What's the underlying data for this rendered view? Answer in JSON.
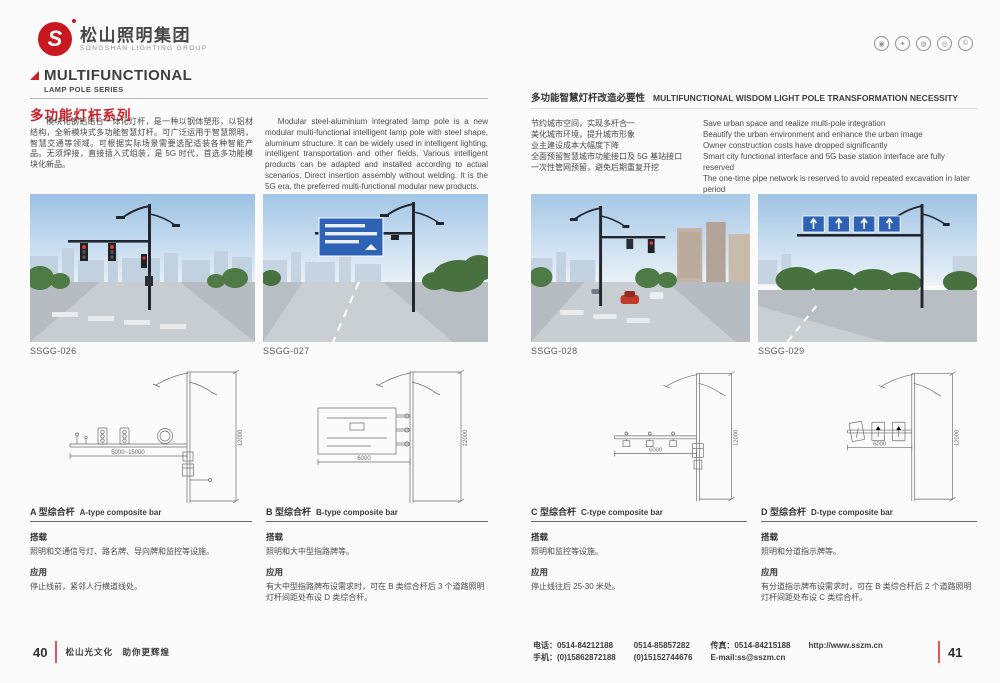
{
  "header": {
    "logo_mark": "S",
    "logo_cn": "松山照明集团",
    "logo_en": "SONGSHAN LIGHTING GROUP"
  },
  "left_page": {
    "series_title_en": "MULTIFUNCTIONAL",
    "series_subtitle_en": "LAMP POLE SERIES",
    "series_title_cn": "多功能灯杆系列",
    "intro_cn": "模块化钢铝结合一体化灯杆，是一种以钢体塑形，以铝材结构，全新模块式多功能智慧灯杆。可广泛运用于智慧照明，智慧交通等领域。可根据实际场景需要选配适装各种智能产品。无须焊接，直接插入式组装，是 5G 时代，首选多功能模块化新品。",
    "intro_en": "Modular steel-aluminium integrated lamp pole is a new modular multi-functional intelligent lamp pole with steel shape, aluminum structure. It can be widely used in intelligent lighting, intelligent transportation and other fields. Various intelligent products can be adapted and installed according to actual scenarios. Direct insertion assembly without welding. It is the 5G era, the preferred multi-functional modular new products.",
    "photo_codes": [
      "SSGG-026",
      "SSGG-027"
    ],
    "sections": [
      {
        "title_cn": "A 型综合杆",
        "title_en": "A-type composite bar",
        "load_label": "搭载",
        "load_text": "照明和交通信号灯、路名牌、导向牌和监控等设施。",
        "app_label": "应用",
        "app_text": "停止线前，紧邻人行横道线处。"
      },
      {
        "title_cn": "B 型综合杆",
        "title_en": "B-type composite bar",
        "load_label": "搭载",
        "load_text": "照明和大中型指路牌等。",
        "app_label": "应用",
        "app_text": "有大中型指路牌布设需求时，可在 B 类综合杆后 3 个道路照明灯杆间距处布设 D 类综合杆。"
      }
    ]
  },
  "right_page": {
    "necessity_title_cn": "多功能智慧灯杆改造必要性",
    "necessity_title_en": "MULTIFUNCTIONAL WISDOM LIGHT POLE TRANSFORMATION NECESSITY",
    "points_cn": [
      "节约城市空间，实现多杆合一",
      "美化城市环境，提升城市形象",
      "业主建设成本大幅度下降",
      "全面预留智慧城市功能接口及 5G 基站接口",
      "一次性管网预留，避免后期重复开挖"
    ],
    "points_en": [
      "Save urban space and realize multi-pole integration",
      "Beautify the urban environment and enhance the urban image",
      "Owner construction costs have dropped significantly",
      "Smart city functional interface and 5G base station interface are fully reserved",
      "The one-time pipe network is reserved to avoid repeated excavation in later period"
    ],
    "photo_codes": [
      "SSGG-028",
      "SSGG-029"
    ],
    "sections": [
      {
        "title_cn": "C 型综合杆",
        "title_en": "C-type composite bar",
        "load_label": "搭载",
        "load_text": "照明和监控等设施。",
        "app_label": "应用",
        "app_text": "停止线往后 25-30 米处。"
      },
      {
        "title_cn": "D 型综合杆",
        "title_en": "D-type composite bar",
        "load_label": "搭载",
        "load_text": "照明和分道指示牌等。",
        "app_label": "应用",
        "app_text": "有分道指示牌布设需求时，可在 B 类综合杆后 2 个道路照明灯杆间距处布设 C 类综合杆。"
      }
    ]
  },
  "drawings": {
    "a": {
      "h_dim": "5000~15000",
      "v_dim": "12000"
    },
    "b": {
      "h_dim": "6000",
      "v_dim": "12000"
    },
    "c": {
      "h_dim": "6000",
      "v_dim": "12000"
    },
    "d": {
      "h_dim": "6000",
      "v_dim": "12000"
    }
  },
  "footer": {
    "left_page_number": "40",
    "left_slogan": "松山光文化　助你更辉煌",
    "right_page_number": "41",
    "contact": {
      "tel": "电话：0514-84212188",
      "tel2": "0514-85857282",
      "mobile": "手机：(0)15862872188",
      "mobile2": "(0)15152744676",
      "fax": "传真：0514-84215188",
      "email": "E-mail:ss@sszm.cn",
      "website": "http://www.sszm.cn"
    }
  }
}
